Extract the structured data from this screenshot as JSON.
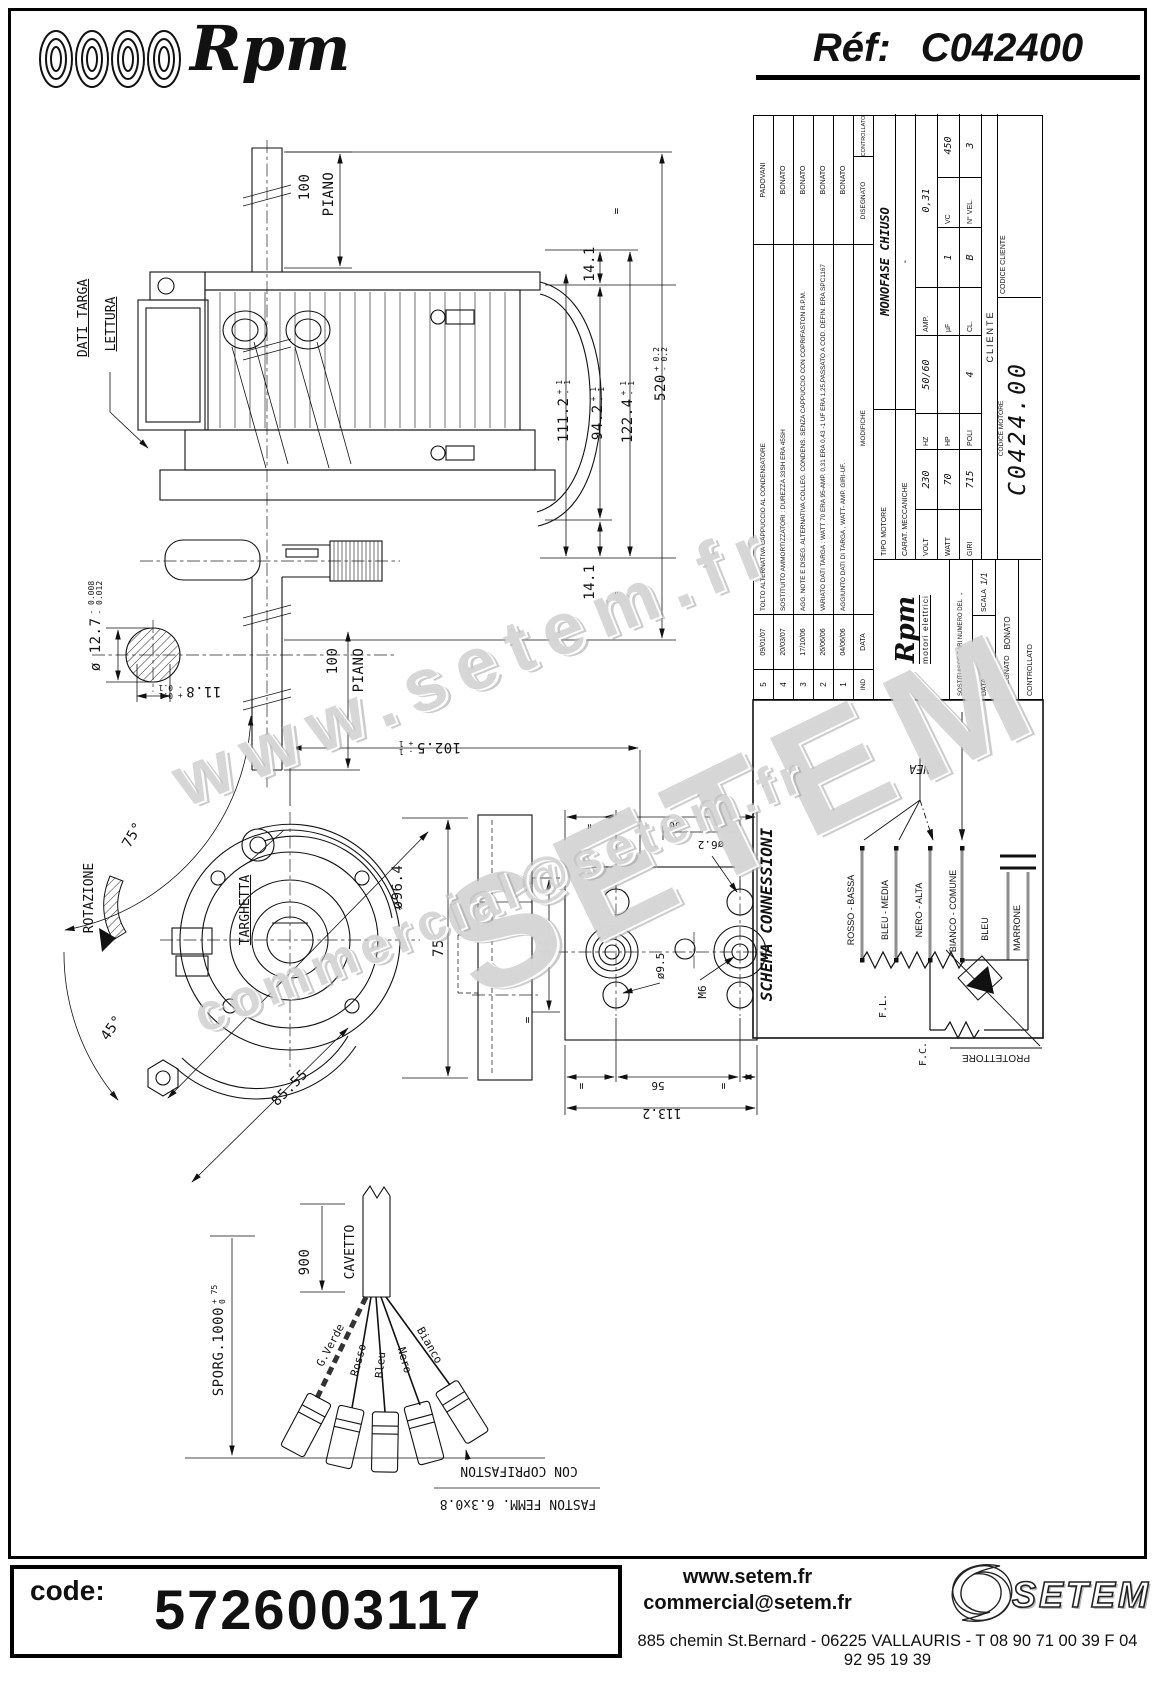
{
  "doc": {
    "ref_label": "Réf:",
    "ref_value": "C042400"
  },
  "brand": {
    "logo": "Rpm",
    "sub": "motori elettrici"
  },
  "watermarks": {
    "line1": "www.setem.fr",
    "line2": "SETEM",
    "line3": "commercial@setem.fr"
  },
  "dims": {
    "d100": "100",
    "piano": "PIANO",
    "d14_1": "14.1",
    "d111_2": "111.2",
    "d94_2": "94.2",
    "d122_4": "122.4",
    "d520": "520",
    "tp1": "+ 1",
    "tm1": "- 1",
    "tp02": "+ 0.2",
    "tm02": "- 0.2",
    "eq": "=",
    "dati_targa": "DATI TARGA",
    "lettura": "LETTURA",
    "dia12_7": "ø 12.7",
    "tm008": "- 0.008",
    "tm012": "- 0.012",
    "d11_8": "11.8",
    "tp01": "+ 0.1",
    "tm01": "- 0.1",
    "a75": "75°",
    "a45": "45°",
    "rotazione": "ROTAZIONE",
    "targhetta": "TARGHETTA",
    "dia96_4": "ø96.4",
    "d85_55": "85.55",
    "d102_5": "102.5",
    "d75": "75",
    "d44": "44",
    "dia6_2": "ø6.2",
    "d60": "60",
    "dia9_5": "ø9.5",
    "m6": "M6",
    "d56": "56",
    "d113_2": "113.2",
    "sporg": "SPORG.1000",
    "tp75": "+ 75",
    "t0": "0",
    "d900": "900",
    "cavetto": "CAVETTO",
    "faston1": "FASTON FEMM. 6.3x0.8",
    "faston2": "CON COPRIFASTON"
  },
  "cable_wires": {
    "gverde": "G.Verde",
    "rosso": "Rosso",
    "bleu": "Bleu",
    "nero": "Nero",
    "bianco": "Bianco"
  },
  "schema": {
    "title": "SCHEMA CONNESSIONI",
    "linea": "LINEA",
    "w1": "ROSSO - BASSA",
    "w2": "BLEU - MEDIA",
    "w3": "NERO - ALTA",
    "w4": "BIANCO - COMUNE",
    "w5": "BLEU",
    "w6": "MARRONE",
    "fl": "F.L.",
    "fc": "F.C.",
    "protettore": "PROTETTORE"
  },
  "title_block": {
    "revisions": {
      "headers": {
        "ind": "IND",
        "data": "DATA",
        "modifiche": "MODIFICHE",
        "disegnato": "DISEGNATO",
        "controllato": "CONTROLLATO"
      },
      "rows": [
        {
          "ind": "5",
          "date": "09/01/07",
          "text": "TOLTO ALTERNATIVA CAPPUCCIO AL CONDENSATORE",
          "name": "PADOVANI"
        },
        {
          "ind": "4",
          "date": "20/03/07",
          "text": "SOSTITUITO AMMORTIZZATORI : DUREZZA 33SH ERA 45SH",
          "name": "BONATO"
        },
        {
          "ind": "3",
          "date": "17/10/06",
          "text": "AGG. NOTE E DISEG. ALTERNATIVA COLLEG. CONDENS. SENZA CAPPUCCIO CON COPRIFASTON R.P.M.",
          "name": "BONATO"
        },
        {
          "ind": "2",
          "date": "26/06/06",
          "text": "VARIATO DATI TARGA : WATT 70 ERA 95-AMP. 0,31 ERA 0,43 -1 UF ERA 1,25,PASSATO A COD. DEFIN. ERA SPC1167",
          "name": "BONATO"
        },
        {
          "ind": "1",
          "date": "04/06/06",
          "text": "AGGIUNTO DATI DI TARGA , WATT- AMP. GIRI-UF.",
          "name": "BONATO"
        }
      ]
    },
    "motor": {
      "tipo_label": "TIPO MOTORE",
      "tipo_value": "MONOFASE CHIUSO",
      "carat_label": "CARAT. MECCANICHE",
      "carat_value": "-",
      "volt_label": "VOLT",
      "volt": "230",
      "hz_label": "HZ",
      "hz": "50/60",
      "amp_label": "AMP.",
      "amp": "0,31",
      "watt_label": "WATT",
      "watt": "70",
      "hp_label": "HP",
      "hp": "",
      "uf_label": "µF",
      "uf": "1",
      "vc_label": "VC",
      "vc": "450",
      "giri_label": "GIRI",
      "giri": "715",
      "poli_label": "POLI",
      "poli": "4",
      "cl_label": "CL.",
      "cl": "B",
      "nvel_label": "N° VEL.",
      "nvel": "3",
      "cliente_label": "CLIENTE",
      "codice_motore_label": "CODICE MOTORE",
      "codice_motore": "C0424.00",
      "codice_cliente_label": "CODICE CLIENTE"
    },
    "meta": {
      "sostituisce_label": "SOSTITUISCE PARI NUMERO DEL",
      "sostituisce_value": "-",
      "data_label": "DATA",
      "data_value": "—23/05/06",
      "scala_label": "SCALA",
      "scala_value": "1/1",
      "disegnato_label": "DISEGNATO",
      "disegnato_value": "BONATO",
      "controllato_label": "CONTROLLATO"
    }
  },
  "footer": {
    "code_label": "code:",
    "code_value": "5726003117",
    "site": "www.setem.fr",
    "email": "commercial@setem.fr",
    "address": "885 chemin St.Bernard  -  06225 VALLAURIS  -  T 08 90 71 00 39   F 04 92 95 19 39",
    "brand": "SETEM"
  }
}
